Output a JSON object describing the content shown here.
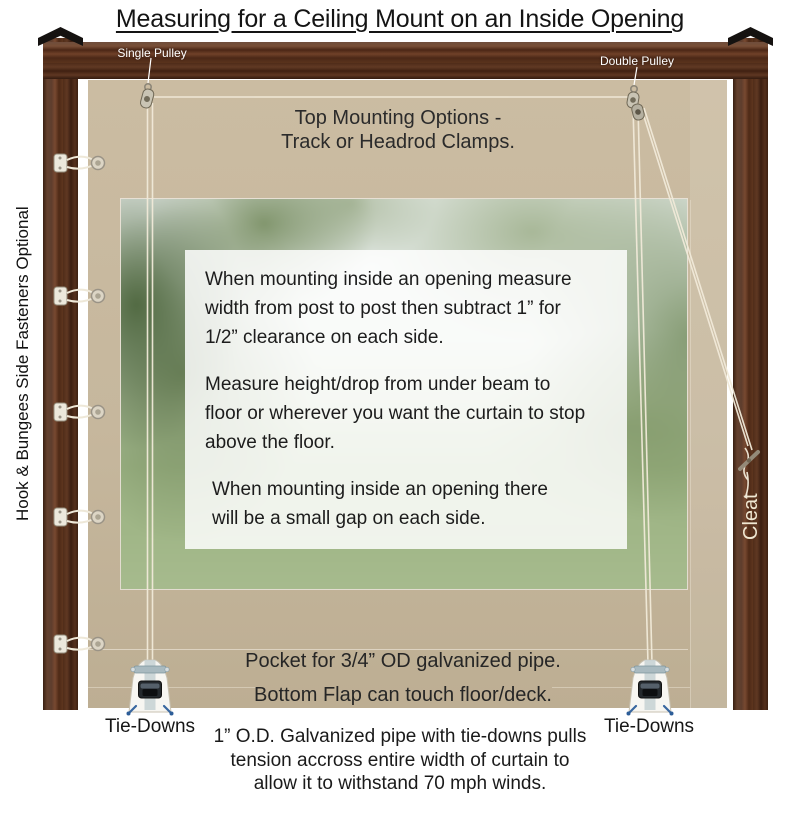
{
  "title": "Measuring for a Ceiling Mount on an Inside Opening",
  "frame": {
    "single_pulley_label": "Single Pulley",
    "double_pulley_label": "Double Pulley",
    "side_fasteners_label": "Hook & Bungees Side Fasteners Optional",
    "cleat_label": "Cleat"
  },
  "curtain": {
    "top_mounting_lines": [
      "Top Mounting Options -",
      "Track or Headrod Clamps."
    ],
    "pocket_label": "Pocket for 3/4” OD galvanized pipe.",
    "bottom_flap_label": "Bottom Flap can touch floor/deck."
  },
  "instructions": {
    "para1_lines": [
      "When mounting inside an opening measure",
      "width from post to post then subtract 1” for",
      "1/2” clearance on each side."
    ],
    "para2_lines": [
      "Measure height/drop from under beam to",
      "floor or wherever you want the curtain to stop",
      "above the floor."
    ],
    "para3_lines": [
      "When mounting inside an opening there",
      "will be a small gap on each side."
    ]
  },
  "tie_downs": {
    "left_label": "Tie-Downs",
    "right_label": "Tie-Downs"
  },
  "footnote_lines": [
    "1” O.D. Galvanized pipe with tie-downs pulls",
    "tension accross entire width of curtain to",
    "allow it to withstand 70 mph winds."
  ],
  "colors": {
    "curtain_tan": "#c6b79d",
    "wood_brown": "#5d341f",
    "rope_cream": "#f1ead9",
    "grass_green": "#a3b789",
    "label_white": "#ffffff",
    "text_black": "#1e1e1e"
  }
}
